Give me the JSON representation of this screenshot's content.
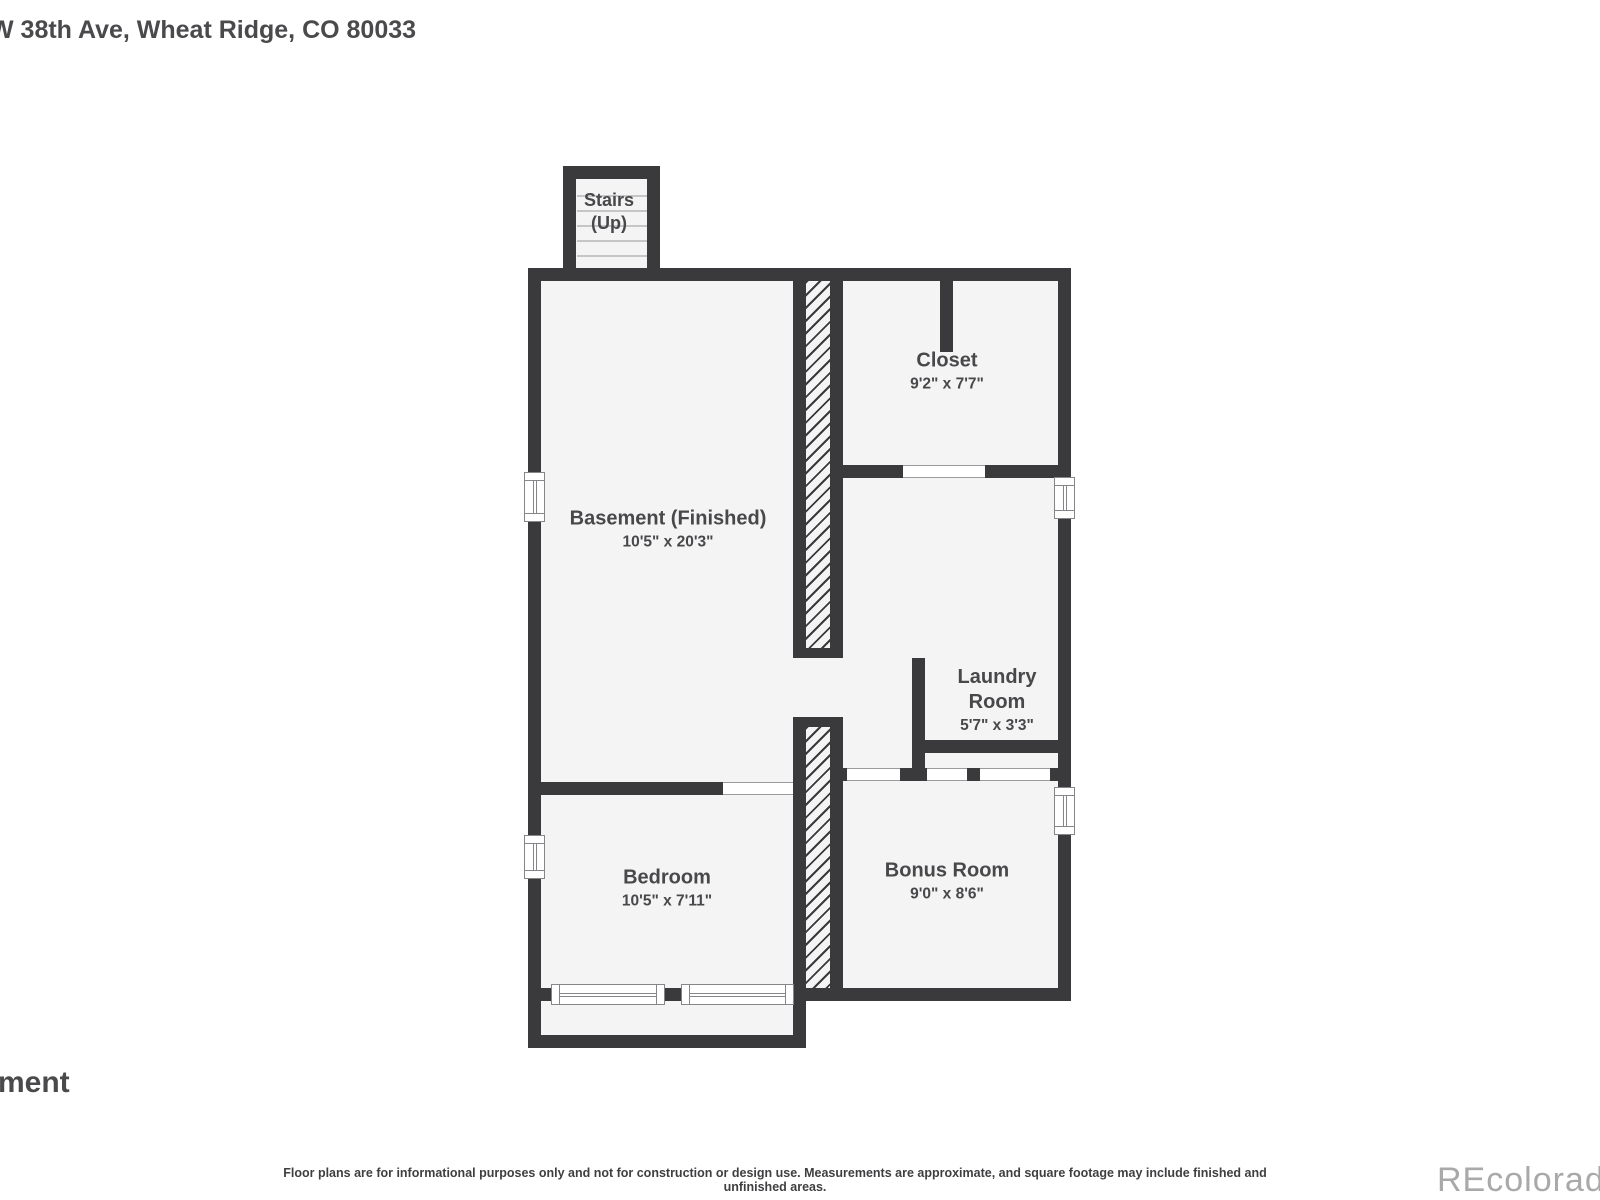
{
  "title": "W 38th Ave, Wheat Ridge, CO 80033",
  "floor_label_partial": "ment",
  "watermark": "REcolorado",
  "disclaimer": "Floor plans are for informational purposes only and not for construction or design use. Measurements are approximate, and square footage may include finished and unfinished areas.",
  "colors": {
    "wall": "#3a3a3c",
    "floor_fill": "#f4f4f5",
    "label_text": "#48484a",
    "watermark_gray": "#a9a9a9"
  },
  "rooms": {
    "stairs": {
      "name": "Stairs",
      "sub": "(Up)"
    },
    "basement": {
      "name": "Basement (Finished)",
      "dims": "10'5\" x 20'3\""
    },
    "closet": {
      "name": "Closet",
      "dims": "9'2\" x 7'7\""
    },
    "laundry": {
      "name_line1": "Laundry",
      "name_line2": "Room",
      "dims": "5'7\" x 3'3\""
    },
    "bedroom": {
      "name": "Bedroom",
      "dims": "10'5\" x 7'11\""
    },
    "bonus": {
      "name": "Bonus Room",
      "dims": "9'0\" x 8'6\""
    }
  }
}
